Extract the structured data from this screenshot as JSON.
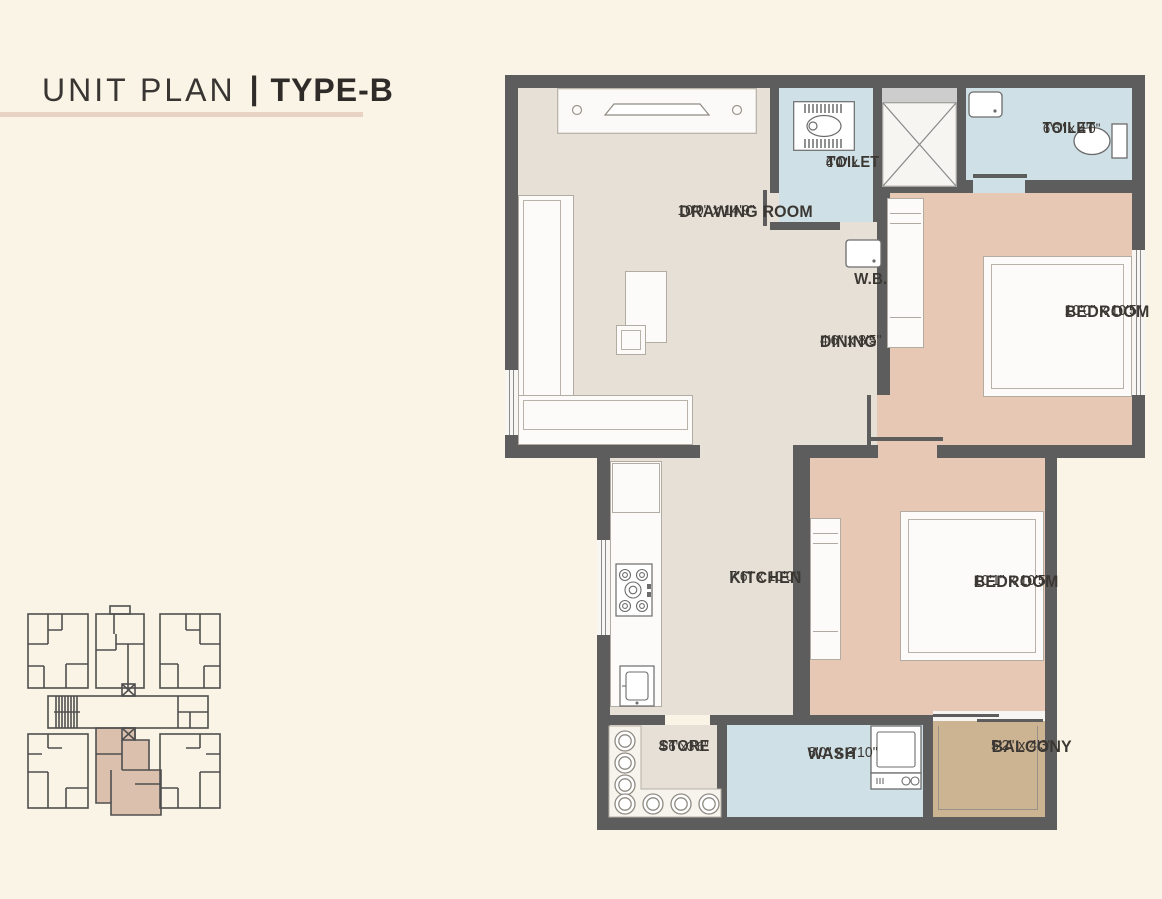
{
  "header": {
    "title": "UNIT PLAN",
    "separator": "|",
    "subtitle": "TYPE-B"
  },
  "rooms": {
    "drawing_room": {
      "name": "DRAWING ROOM",
      "dims": "10'0\" x 14'9\""
    },
    "toilet_1": {
      "name": "TOILET",
      "dims_line1": "4'1\" x",
      "dims_line2": "6'0\""
    },
    "toilet_2": {
      "name": "TOILET",
      "dims": "6'6\" x 4'0\""
    },
    "wb": {
      "name": "W.B."
    },
    "bedroom_1": {
      "name": "BEDROOM",
      "dims": "10'0\" x 10'5\""
    },
    "dining": {
      "name": "DINING",
      "dims": "4'6\" x 8'5\""
    },
    "kitchen": {
      "name": "KITCHEN",
      "dims": "7'6\" x 10'0\""
    },
    "bedroom_2": {
      "name": "BEDROOM",
      "dims": "10'1\" x 10'5\""
    },
    "store": {
      "name": "STORE",
      "dims": "4'6\"x3'6\""
    },
    "wash": {
      "name": "WASH",
      "dims": "8'0\" x 3'10\""
    },
    "balcony": {
      "name": "BALCONY",
      "dims": "5'2\" x 4'3\""
    }
  },
  "colors": {
    "background": "#faf4e6",
    "wall": "#5d5d5d",
    "floor_living": "#e6e0d7",
    "floor_bedroom": "#e6c8b5",
    "floor_toilet": "#cfe0e6",
    "floor_balcony": "#ccb392",
    "title_underline": "#e8d2c4",
    "keyplan_highlight": "#dcc0ae",
    "text": "#3b3733"
  }
}
